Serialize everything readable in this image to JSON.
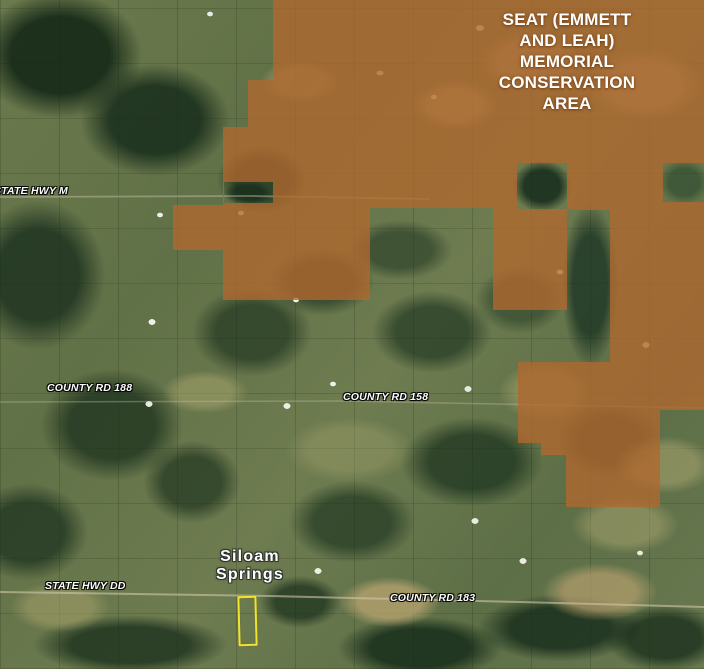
{
  "map": {
    "view_type": "satellite",
    "conservation_area": {
      "name": "SEAT (EMMETT AND LEAH) MEMORIAL CONSERVATION AREA",
      "title_lines": [
        "SEAT (EMMETT",
        "AND LEAH)",
        "MEMORIAL",
        "CONSERVATION",
        "AREA"
      ],
      "overlay_color": "#b1682e",
      "overlay_opacity": "0.78"
    },
    "road_labels": [
      {
        "text": "STATE HWY M"
      },
      {
        "text": "COUNTY RD 188"
      },
      {
        "text": "COUNTY RD 158"
      },
      {
        "text": "STATE HWY DD"
      },
      {
        "text": "COUNTY RD 183"
      }
    ],
    "place_label": {
      "name": "Siloam Springs",
      "line1": "Siloam",
      "line2": "Springs"
    },
    "parcel_marker": {
      "shape": "rectangle-outline",
      "color": "#f1e42c"
    }
  }
}
